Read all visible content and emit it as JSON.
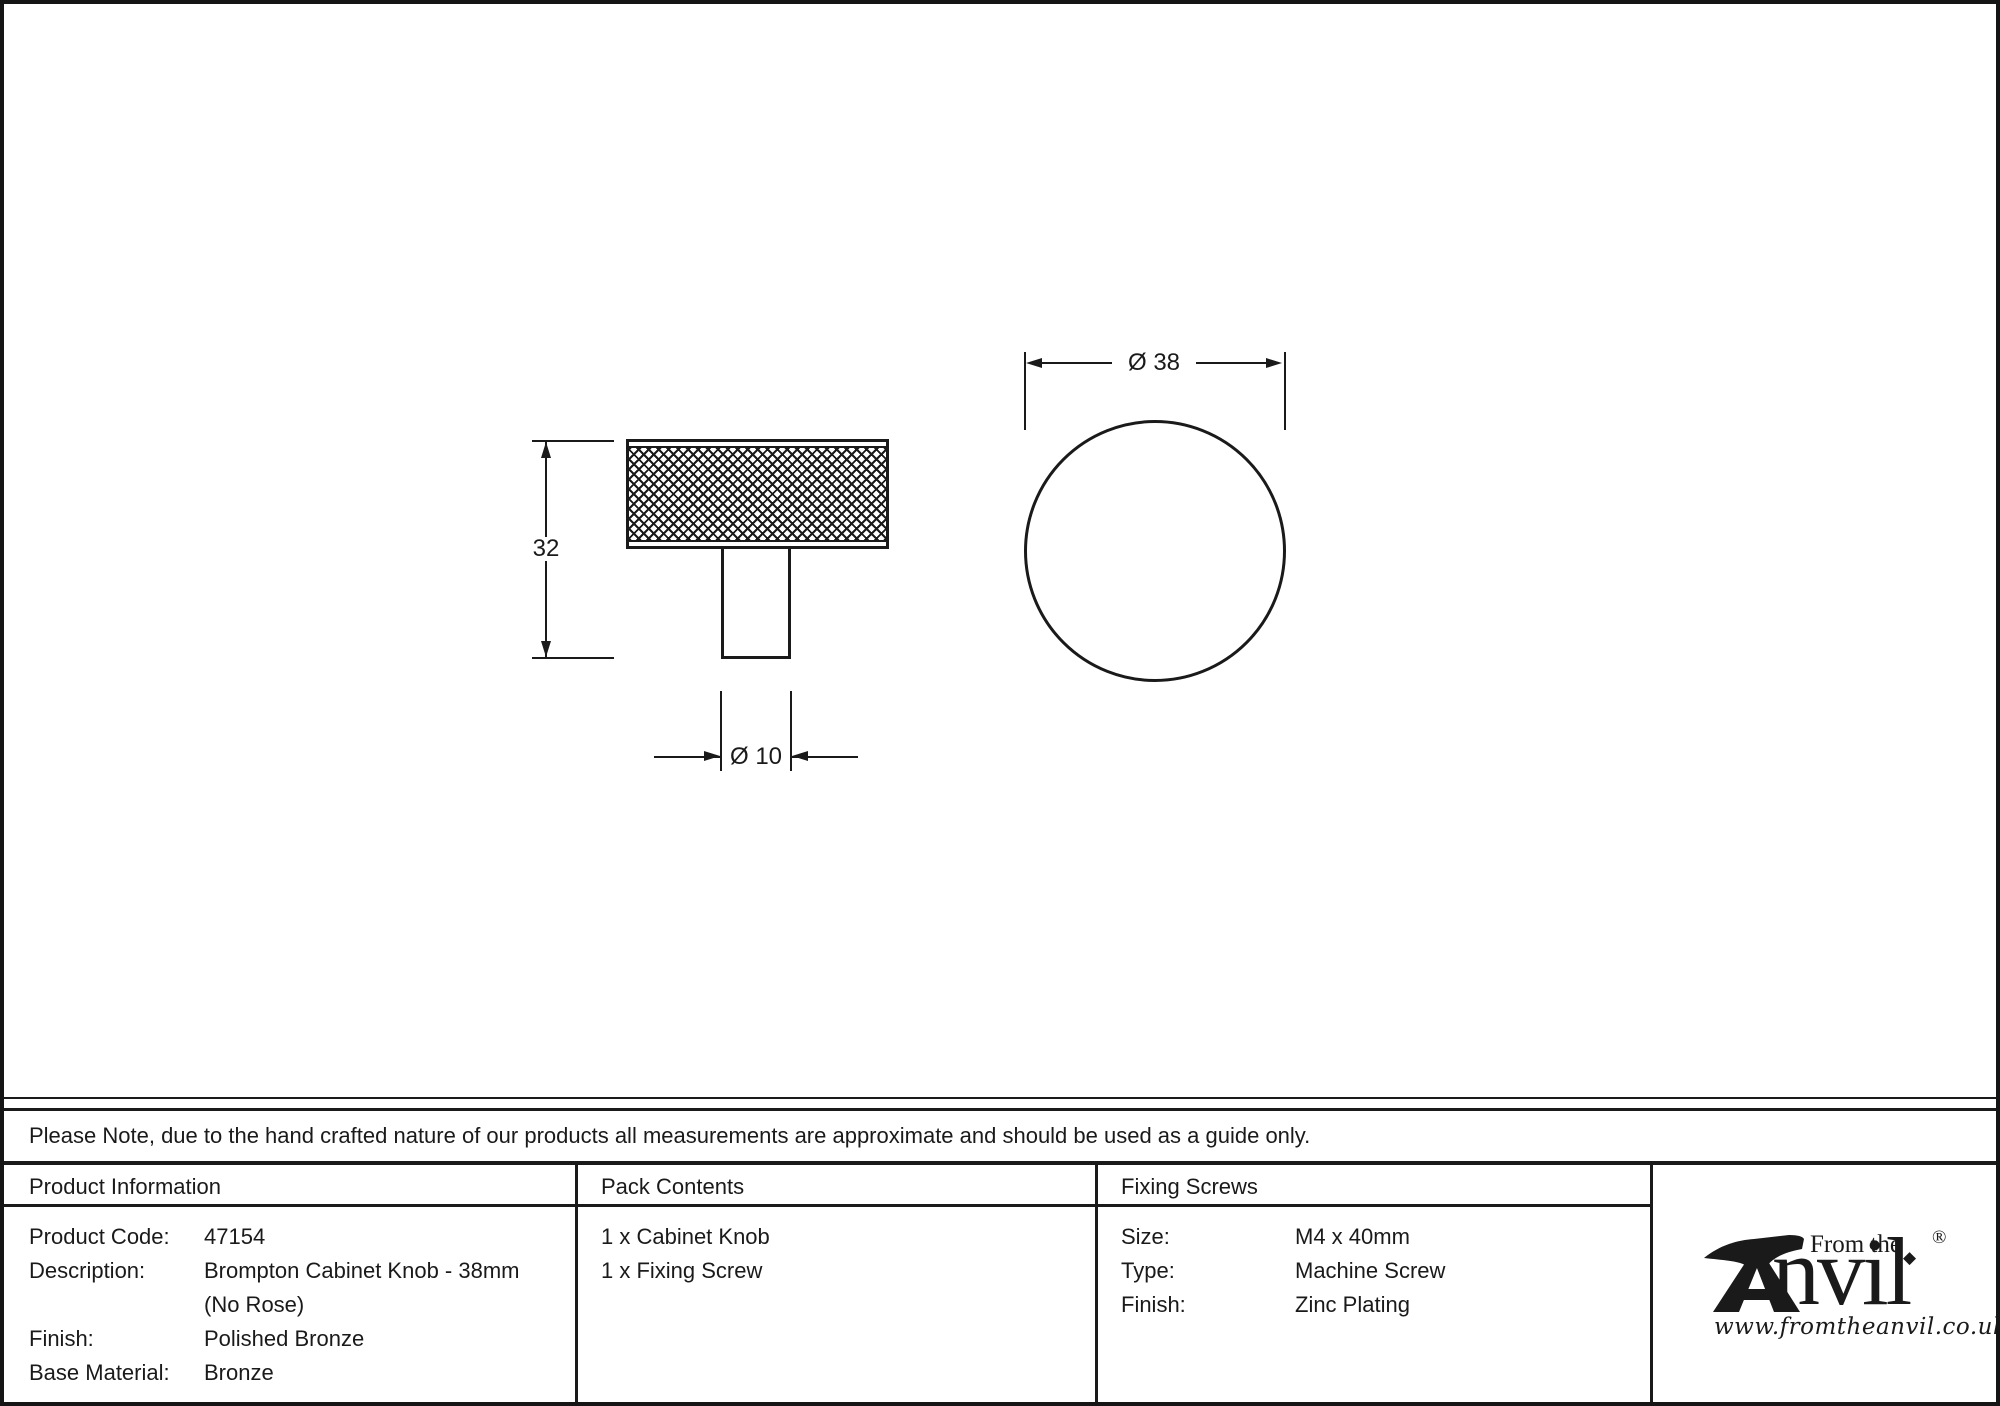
{
  "colors": {
    "ink": "#1a1a1a",
    "paper": "#ffffff"
  },
  "drawing": {
    "side_view": {
      "height_label": "32",
      "stem_diameter_label": "Ø 10"
    },
    "top_view": {
      "diameter_label": "Ø 38"
    }
  },
  "note": {
    "text": "Please Note, due to the hand crafted nature of our products all measurements are approximate and should be used as a guide only."
  },
  "table": {
    "product_info": {
      "header": "Product Information",
      "rows": [
        {
          "label": "Product Code:",
          "value": "47154"
        },
        {
          "label": "Description:",
          "value": "Brompton Cabinet Knob - 38mm"
        },
        {
          "label": "",
          "value": "(No Rose)"
        },
        {
          "label": "Finish:",
          "value": "Polished Bronze"
        },
        {
          "label": "Base Material:",
          "value": "Bronze"
        }
      ]
    },
    "pack_contents": {
      "header": "Pack Contents",
      "items": [
        "1 x Cabinet Knob",
        "1 x Fixing Screw"
      ]
    },
    "fixing_screws": {
      "header": "Fixing Screws",
      "rows": [
        {
          "label": "Size:",
          "value": "M4 x 40mm"
        },
        {
          "label": "Type:",
          "value": "Machine Screw"
        },
        {
          "label": "Finish:",
          "value": "Zinc Plating"
        }
      ]
    }
  },
  "logo": {
    "from_the": "From the",
    "brand_suffix": "nvil",
    "diamond": "◆",
    "registered": "®",
    "url": "www.fromtheanvil.co.uk"
  }
}
